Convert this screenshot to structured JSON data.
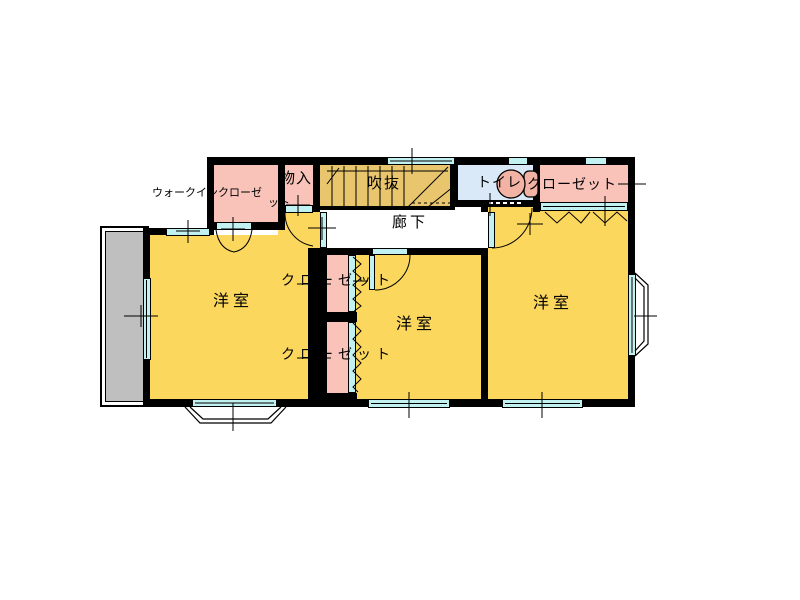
{
  "figure": "second-floor-plan",
  "palette": {
    "wall": "#000000",
    "room_yellow": "#FBD75E",
    "stairs_tan": "#E9C66E",
    "closet_pink": "#F9C3BA",
    "window_cyan": "#C2F1F1",
    "toilet_room_blue": "#D9E9F8",
    "toilet_fixture_salmon": "#F2B3A4",
    "balcony_gray": "#BFBFBF",
    "background": "#FFFFFF",
    "line": "#000000"
  },
  "labels": {
    "room_left": "洋室",
    "room_middle": "洋室",
    "room_right": "洋室",
    "hallway": "廊下",
    "atrium": "吹抜",
    "toilet": "トイレ",
    "storage": "物入",
    "walk_in_full": "ウォークインクローゼット",
    "walk_in_line1": "ウォークインクローゼ",
    "walk_in_line2": "ット",
    "closet_top_right": "クローゼット",
    "closet_middle_upper": "クローゼット",
    "closet_middle_lower": "クローゼット"
  },
  "icons": [
    {
      "name": "toilet-icon",
      "meaning": "toilet bowl and tank fixture"
    }
  ],
  "features": {
    "doors": [
      "storage-swing-door",
      "walk-in-double-door",
      "middle-room-swing-door",
      "right-room-swing-door",
      "toilet-sliding-door"
    ],
    "folding_doors": [
      "closet-top-right",
      "closet-middle-upper",
      "closet-middle-lower"
    ],
    "windows": [
      "top-wall-window",
      "toilet-top-window",
      "closet-top-window",
      "left-room-top-window",
      "balcony-window",
      "left-bay-window",
      "middle-bottom-window",
      "right-bottom-window",
      "right-bay-window"
    ],
    "stairs_in": "atrium",
    "balcony_side": "left"
  }
}
